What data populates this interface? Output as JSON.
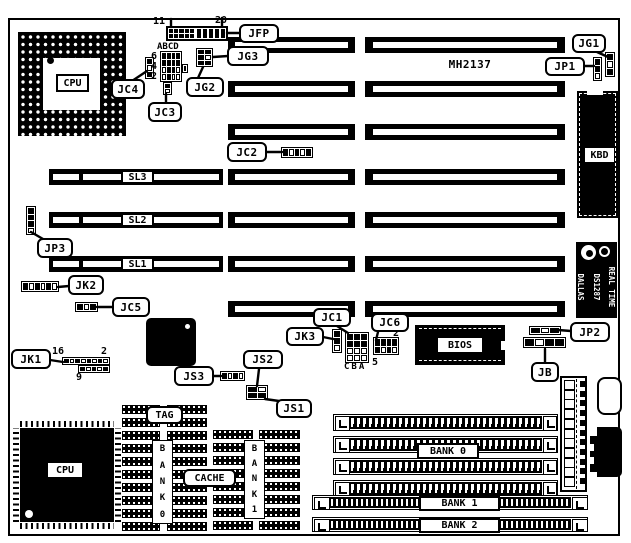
{
  "diagram": {
    "board_model": "MH2137",
    "labels": {
      "jfp": "JFP",
      "jg1": "JG1",
      "jg2": "JG2",
      "jg3": "JG3",
      "jp1": "JP1",
      "jc4": "JC4",
      "jc3": "JC3",
      "jc2": "JC2",
      "jp3": "JP3",
      "jk2": "JK2",
      "jc5": "JC5",
      "jk1": "JK1",
      "js3": "JS3",
      "js2": "JS2",
      "js1": "JS1",
      "jk3": "JK3",
      "jc1": "JC1",
      "jc6": "JC6",
      "jp2": "JP2",
      "jb": "JB",
      "sl1": "SL1",
      "sl2": "SL2",
      "sl3": "SL3",
      "tag": "TAG",
      "cache": "CACHE",
      "bank0_vertical": "BANK0",
      "bank1_vertical": "BANK1",
      "bank0": "BANK 0",
      "bank1": "BANK 1",
      "bank2": "BANK 2",
      "bios": "BIOS",
      "kbd": "KBD",
      "cpu_socket": "CPU",
      "cpu_chip": "CPU"
    },
    "pin_numbers": {
      "jfp_pin11": "11",
      "jfp_pin20": "20",
      "jc4_col_letters": "ABCD",
      "jc4_pin6": "6",
      "jc4_pin4": "4",
      "jc4_pin2": "2",
      "jk1_pin16": "16",
      "jk1_pin2": "2",
      "jk1_pin9": "9",
      "jc1_col_letters": "CBA",
      "jc6_pin2": "2",
      "jc6_pin5": "5"
    },
    "rtc": {
      "brand": "DALLAS",
      "part": "DS1287",
      "type": "REAL TIME"
    },
    "colors": {
      "ink": "#000000",
      "paper": "#ffffff"
    }
  }
}
